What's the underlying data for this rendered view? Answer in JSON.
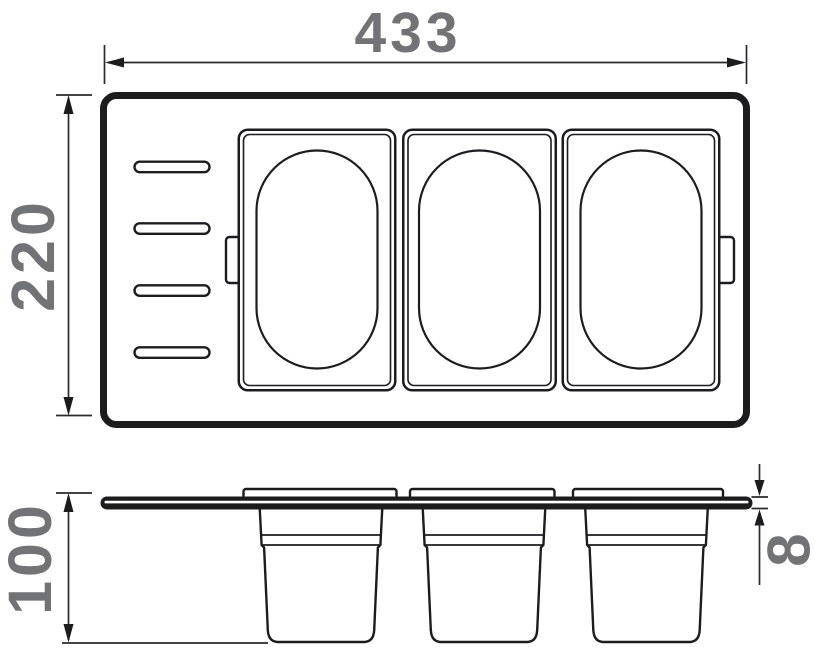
{
  "dimensions": {
    "width": {
      "value": "433"
    },
    "depth": {
      "value": "220"
    },
    "bin_height": {
      "value": "100"
    },
    "plate_thickness": {
      "value": "8"
    }
  },
  "views": {
    "top": {
      "containers": 3,
      "slots": 4,
      "side_tabs": 2
    },
    "side": {
      "bins": 3
    }
  },
  "colors": {
    "line": "#1c1c1e",
    "dimension_text": "#727376",
    "background": "#ffffff"
  }
}
